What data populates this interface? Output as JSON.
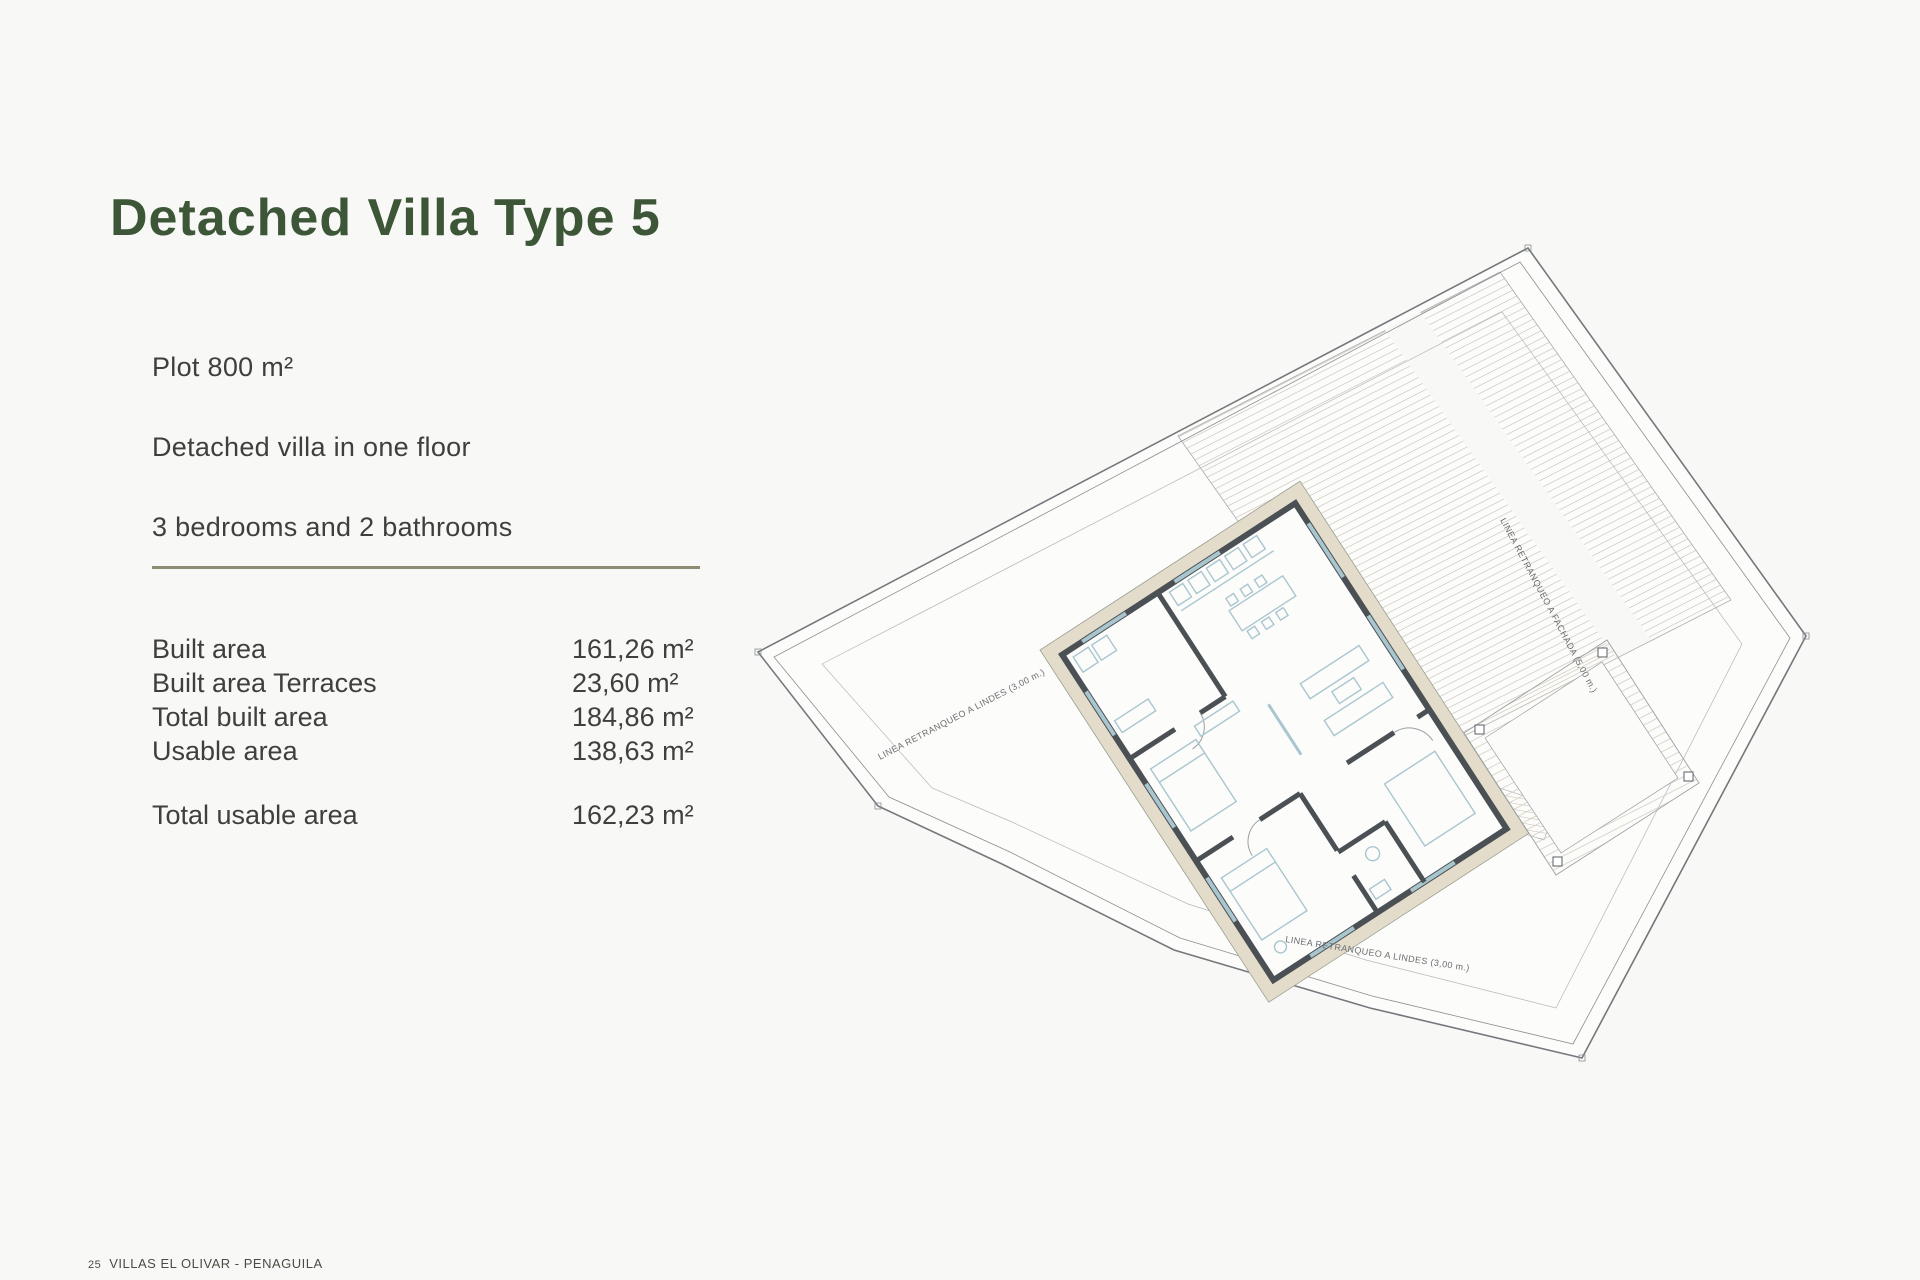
{
  "title": "Detached Villa Type 5",
  "description": {
    "plot": "Plot 800 m²",
    "floor": "Detached villa in one floor",
    "rooms": "3 bedrooms and 2 bathrooms"
  },
  "areas": {
    "rows": [
      {
        "label": "Built area",
        "value": "161,26 m²"
      },
      {
        "label": "Built area Terraces",
        "value": "23,60 m²"
      },
      {
        "label": "Total built area",
        "value": "184,86 m²"
      },
      {
        "label": "Usable area",
        "value": "138,63 m²"
      }
    ],
    "total": {
      "label": "Total usable area",
      "value": "162,23 m²"
    }
  },
  "footer": {
    "page_number": "25",
    "project": "VILLAS EL OLIVAR - PENAGUILA"
  },
  "plan": {
    "labels": {
      "setback_left": "LINEA RETRANQUEO A LINDES (3,00 m.)",
      "setback_bottom": "LINEA RETRANQUEO A LINDES (3,00 m.)",
      "setback_facade": "LINEA RETRANQUEO A FACHADA (5,00 m.)"
    }
  },
  "colors": {
    "accent_green": "#3c5637",
    "divider_olive": "#8e8c72",
    "page_bg": "#f8f8f6",
    "wall_dark": "#4b5055",
    "band_beige": "#e3dccb",
    "furniture_blue": "#a9c6cf"
  }
}
